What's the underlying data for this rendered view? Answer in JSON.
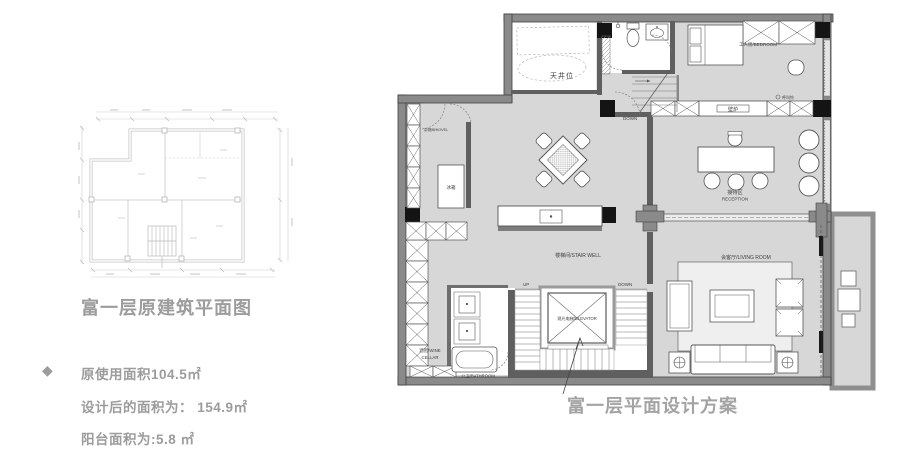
{
  "colors": {
    "floor": "#d7d7d7",
    "wall": "#8a8a8a",
    "wall_dark": "#5f5f5f",
    "column": "#141414",
    "faint_plan": "#c2c2c2",
    "title_gray": "#9c9c9c",
    "label_dark": "#3d3d3d"
  },
  "left_panel": {
    "title": "富一层原建筑平面图",
    "bullet_icon": "◆",
    "stats": [
      {
        "text": "原使用面积104.5㎡"
      },
      {
        "text": "设计后的面积为： 154.9㎡"
      },
      {
        "text": "阳台面积为:5.8 ㎡"
      }
    ]
  },
  "right_panel": {
    "title": "富一层平面设计方案",
    "labels": {
      "skylight": "天井位",
      "down_top": "DOWN",
      "maid_room": "工人房/BEDROOM",
      "call_bell": "呼叫铃",
      "fireplace": "壁炉",
      "reception_cn": "接待区",
      "reception_en": "RECEPTION",
      "storage": "杂物间/HOVEL",
      "fridge": "冰箱",
      "stairwell": "楼梯间/STAIR WELL",
      "living_room": "会客厅/LIVING ROOM",
      "up": "UP",
      "down_mid": "DOWN",
      "elevator": "观光电梯/ELEVATOR",
      "wine_cellar_line1": "酒窖/WINE",
      "wine_cellar_line2": "CELLAR",
      "bathroom": "公卫/BATHROOM"
    }
  }
}
